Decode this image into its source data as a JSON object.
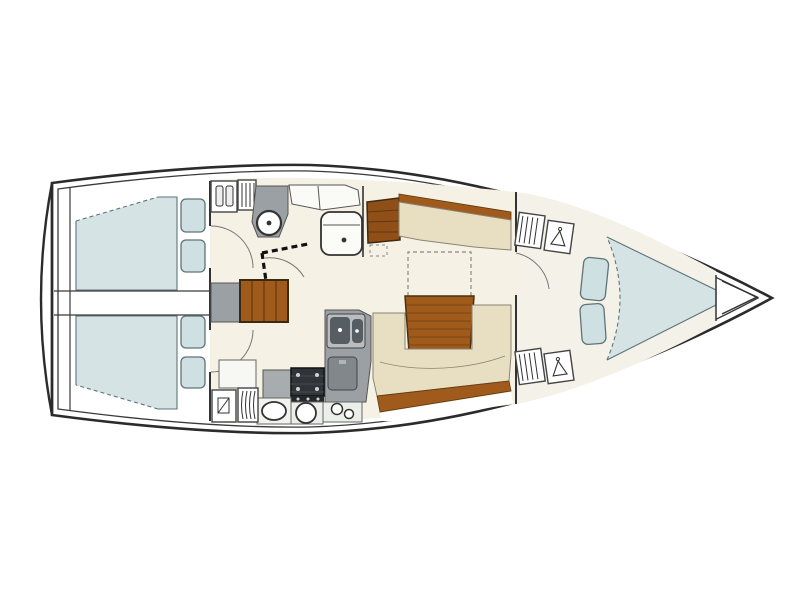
{
  "title": "Sailing yacht interior deck plan",
  "vessel": {
    "view": "top-down floor plan",
    "orientation": "bow to the right, stern to the left",
    "cabin_count": 3
  },
  "colors": {
    "hull_outline": "#2b2b2b",
    "inner_line": "#3a3a3a",
    "floor": "#f5f1e4",
    "floor_forward": "#f4f1e8",
    "white": "#ffffff",
    "berth": "#d5e3e5",
    "berth_border": "#5e7479",
    "cushion": "#cfe0e3",
    "settee": "#e8dfc3",
    "settee_border": "#8a8473",
    "wood": "#a05a1b",
    "wood_dark": "#6e3d10",
    "sideboard": "#8f4f16",
    "counter": "#9ba0a4",
    "counter_light": "#b9bdc0",
    "appliance": "#81878b",
    "basin_dark": "#565e63",
    "stove": "#2e3437",
    "wall": "#333333",
    "door_arc": "#777777"
  },
  "areas": [
    {
      "id": "transom",
      "label": "transom / swim platform"
    },
    {
      "id": "aft-cabin-port",
      "label": "aft double cabin (top)"
    },
    {
      "id": "aft-cabin-starboard",
      "label": "aft double cabin (bottom)"
    },
    {
      "id": "engine-compartment",
      "label": "engine compartment between aft cabins"
    },
    {
      "id": "head",
      "label": "head with washbasin, toilet and shower"
    },
    {
      "id": "companionway",
      "label": "companionway steps"
    },
    {
      "id": "galley",
      "label": "L-shaped galley with double sink, stove and fridge"
    },
    {
      "id": "saloon",
      "label": "saloon with settees and folding table"
    },
    {
      "id": "forward-cabin",
      "label": "forward cabin with V-berth"
    },
    {
      "id": "anchor-locker",
      "label": "anchor locker at bow"
    }
  ],
  "furniture": [
    "double berth",
    "pillows",
    "wardrobe lockers",
    "shelf lockers",
    "washbasin",
    "toilet",
    "shower folding door",
    "companionway stairs",
    "galley counters",
    "double sink",
    "stove with oven",
    "fridge",
    "sideboard",
    "straight settee",
    "U-settee",
    "saloon table",
    "table extension (dashed)",
    "V-berth",
    "berth seat cushions"
  ]
}
